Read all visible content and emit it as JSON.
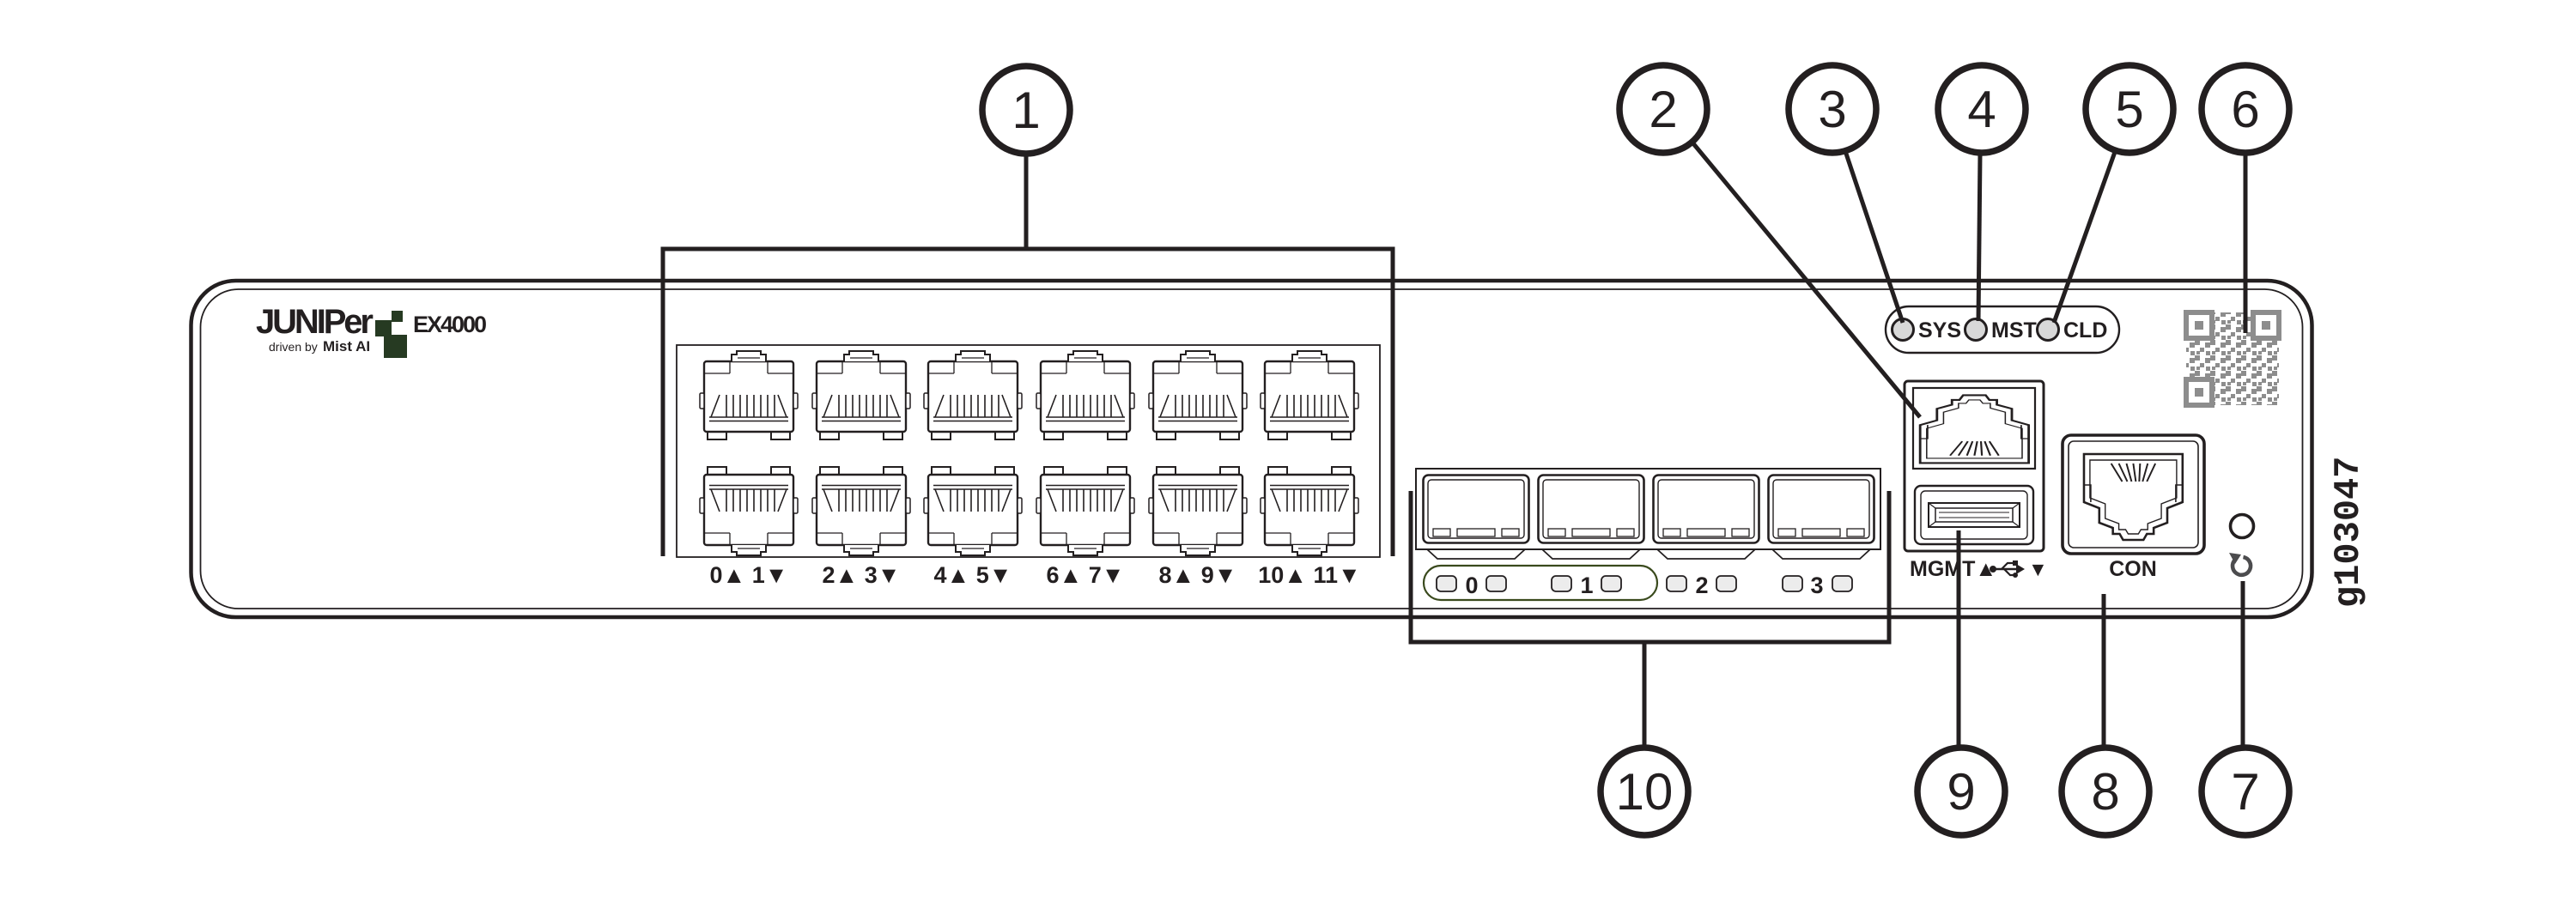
{
  "brand": {
    "wordmark": "JUNIPer",
    "tagline_prefix": "driven by",
    "tagline_brand": "Mist AI",
    "model": "EX4000"
  },
  "figure_id": "g103047",
  "access_ports": {
    "pair_labels": [
      "0▲ 1▼",
      "2▲ 3▼",
      "4▲ 5▼",
      "6▲ 7▼",
      "8▲ 9▼",
      "10▲ 11▼"
    ]
  },
  "uplink_ports": {
    "group_numbers": [
      "0",
      "1",
      "2",
      "3"
    ]
  },
  "status_leds": [
    "SYS",
    "MST",
    "CLD"
  ],
  "management": {
    "mgmt_label": "MGMT▲",
    "usb_down_arrow": "▼",
    "console_label": "CON"
  },
  "callouts": [
    "1",
    "2",
    "3",
    "4",
    "5",
    "6",
    "7",
    "8",
    "9",
    "10"
  ],
  "colors": {
    "line": "#231f20",
    "brand_green": "#263a22",
    "qr_gray": "#8d8d8d",
    "uplink_led_ring_green": "#3a4a1d",
    "reset_icon_gray": "#4c4c4e"
  }
}
